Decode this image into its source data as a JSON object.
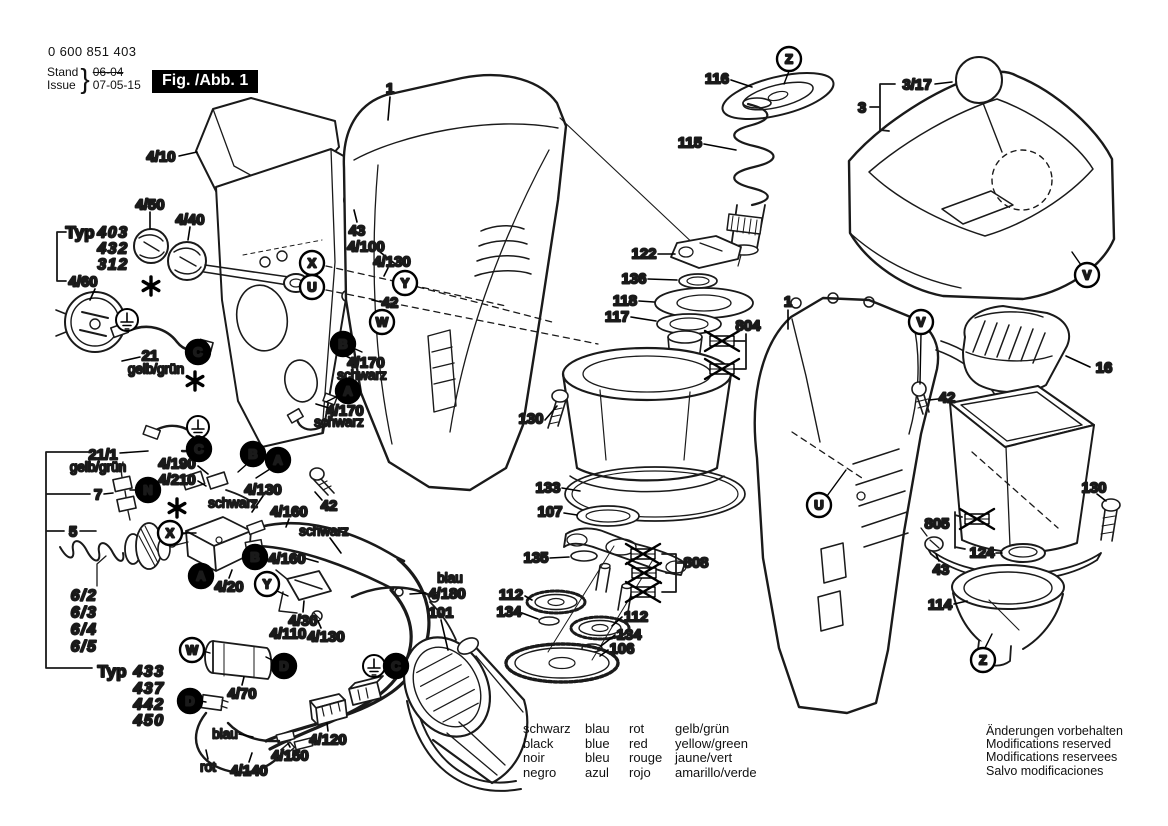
{
  "header": {
    "doc_number": "0 600 851 403",
    "stand_label": "Stand",
    "issue_label": "Issue",
    "brace": "}",
    "stand_value": "06-04",
    "issue_value": "07-05-15",
    "figure_label": "Fig. /Abb. 1"
  },
  "color_legend": {
    "rows": [
      [
        "schwarz",
        "blau",
        "rot",
        "gelb/grün"
      ],
      [
        "black",
        "blue",
        "red",
        "yellow/green"
      ],
      [
        "noir",
        "bleu",
        "rouge",
        "jaune/vert"
      ],
      [
        "negro",
        "azul",
        "rojo",
        "amarillo/verde"
      ]
    ]
  },
  "footer_notes": [
    "Änderungen vorbehalten",
    "Modifications reserved",
    "Modifications reservees",
    "Salvo modificaciones"
  ],
  "diagram": {
    "part_labels": [
      {
        "t": "1",
        "x": 390,
        "y": 88,
        "l": [
          390,
          97,
          388,
          120
        ]
      },
      {
        "t": "4/10",
        "x": 161,
        "y": 156,
        "l": [
          179,
          156,
          197,
          152
        ]
      },
      {
        "t": "4/50",
        "x": 150,
        "y": 204,
        "l": [
          150,
          212,
          150,
          228
        ]
      },
      {
        "t": "4/40",
        "x": 190,
        "y": 219,
        "l": [
          190,
          227,
          188,
          240
        ]
      },
      {
        "t": "43",
        "x": 357,
        "y": 230,
        "l": [
          357,
          222,
          354,
          210
        ]
      },
      {
        "t": "4/100",
        "x": 366,
        "y": 246,
        "l": [
          380,
          252,
          398,
          266
        ]
      },
      {
        "t": "4/130",
        "x": 392,
        "y": 261,
        "l": [
          388,
          268,
          384,
          276
        ]
      },
      {
        "t": "42",
        "x": 390,
        "y": 302,
        "l": [
          381,
          302,
          372,
          300
        ]
      },
      {
        "t": "4/170",
        "x": 366,
        "y": 362,
        "l": [
          350,
          358,
          338,
          352
        ]
      },
      {
        "t": "schwarz",
        "x": 362,
        "y": 375,
        "k": "c"
      },
      {
        "t": "4/170",
        "x": 345,
        "y": 410,
        "l": [
          329,
          408,
          316,
          404
        ]
      },
      {
        "t": "schwarz",
        "x": 339,
        "y": 422,
        "k": "c"
      },
      {
        "t": "Typ",
        "x": 80,
        "y": 232,
        "k": "typ"
      },
      {
        "t": "403",
        "x": 113,
        "y": 232,
        "k": "it"
      },
      {
        "t": "432",
        "x": 113,
        "y": 248,
        "k": "it"
      },
      {
        "t": "312",
        "x": 113,
        "y": 264,
        "k": "it"
      },
      {
        "t": "4/60",
        "x": 83,
        "y": 281,
        "l": [
          95,
          289,
          90,
          300
        ]
      },
      {
        "t": "21",
        "x": 150,
        "y": 355,
        "l": [
          140,
          357,
          122,
          361
        ]
      },
      {
        "t": "gelb/grün",
        "x": 156,
        "y": 369,
        "k": "c"
      },
      {
        "t": "21/1",
        "x": 103,
        "y": 454,
        "l": [
          120,
          453,
          148,
          451
        ]
      },
      {
        "t": "gelb/grün",
        "x": 98,
        "y": 467,
        "k": "c"
      },
      {
        "t": "7",
        "x": 98,
        "y": 494,
        "l": [
          104,
          494,
          113,
          493
        ]
      },
      {
        "t": "4/190",
        "x": 177,
        "y": 463,
        "l": [
          198,
          466,
          208,
          474
        ]
      },
      {
        "t": "4/210",
        "x": 177,
        "y": 479,
        "l": [
          198,
          481,
          206,
          486
        ]
      },
      {
        "t": "schwarz",
        "x": 233,
        "y": 503,
        "k": "c"
      },
      {
        "t": "4/130",
        "x": 263,
        "y": 489,
        "l": [
          263,
          496,
          252,
          512
        ]
      },
      {
        "t": "5",
        "x": 73,
        "y": 531,
        "l": [
          80,
          531,
          96,
          531
        ]
      },
      {
        "t": "6/2",
        "x": 84,
        "y": 595,
        "k": "it"
      },
      {
        "t": "6/3",
        "x": 84,
        "y": 612,
        "k": "it"
      },
      {
        "t": "6/4",
        "x": 84,
        "y": 629,
        "k": "it"
      },
      {
        "t": "6/5",
        "x": 84,
        "y": 646,
        "k": "it"
      },
      {
        "t": "Typ",
        "x": 112,
        "y": 671,
        "k": "typ"
      },
      {
        "t": "433",
        "x": 149,
        "y": 671,
        "k": "it"
      },
      {
        "t": "437",
        "x": 149,
        "y": 688,
        "k": "it"
      },
      {
        "t": "442",
        "x": 149,
        "y": 704,
        "k": "it"
      },
      {
        "t": "450",
        "x": 149,
        "y": 720,
        "k": "it"
      },
      {
        "t": "4/20",
        "x": 229,
        "y": 586,
        "l": [
          229,
          578,
          232,
          570
        ]
      },
      {
        "t": "4/160",
        "x": 289,
        "y": 511,
        "l": [
          289,
          519,
          286,
          527
        ]
      },
      {
        "t": "schwarz",
        "x": 324,
        "y": 531,
        "k": "c",
        "l": [
          330,
          538,
          341,
          553
        ]
      },
      {
        "t": "4/160",
        "x": 287,
        "y": 558,
        "l": [
          304,
          558,
          318,
          562
        ]
      },
      {
        "t": "42",
        "x": 329,
        "y": 505,
        "l": [
          322,
          500,
          315,
          492
        ]
      },
      {
        "t": "blau",
        "x": 450,
        "y": 578,
        "k": "c"
      },
      {
        "t": "4/180",
        "x": 447,
        "y": 593,
        "l": [
          425,
          593,
          410,
          594
        ]
      },
      {
        "t": "101",
        "x": 441,
        "y": 612,
        "l": [
          441,
          620,
          448,
          650
        ]
      },
      {
        "t": "4/30",
        "x": 303,
        "y": 620,
        "l": [
          303,
          612,
          304,
          601
        ]
      },
      {
        "t": "4/110",
        "x": 288,
        "y": 633
      },
      {
        "t": "4/130",
        "x": 326,
        "y": 636,
        "l": [
          321,
          628,
          318,
          621
        ]
      },
      {
        "t": "4/70",
        "x": 242,
        "y": 693,
        "l": [
          242,
          685,
          244,
          677
        ]
      },
      {
        "t": "blau",
        "x": 225,
        "y": 734,
        "k": "c",
        "l": [
          239,
          734,
          253,
          737
        ]
      },
      {
        "t": "4/120",
        "x": 328,
        "y": 739,
        "l": [
          328,
          731,
          327,
          723
        ]
      },
      {
        "t": "4/150",
        "x": 290,
        "y": 755,
        "l": [
          290,
          747,
          288,
          743
        ]
      },
      {
        "t": "rot",
        "x": 208,
        "y": 767,
        "k": "c",
        "l": [
          208,
          759,
          206,
          750
        ]
      },
      {
        "t": "4/140",
        "x": 249,
        "y": 770,
        "l": [
          249,
          762,
          252,
          753
        ]
      },
      {
        "t": "116",
        "x": 717,
        "y": 78,
        "l": [
          731,
          80,
          752,
          87
        ]
      },
      {
        "t": "115",
        "x": 690,
        "y": 142,
        "l": [
          704,
          144,
          736,
          150
        ]
      },
      {
        "t": "122",
        "x": 644,
        "y": 253,
        "l": [
          658,
          254,
          675,
          254
        ]
      },
      {
        "t": "136",
        "x": 634,
        "y": 278,
        "l": [
          648,
          279,
          677,
          280
        ]
      },
      {
        "t": "118",
        "x": 625,
        "y": 300,
        "l": [
          639,
          301,
          654,
          302
        ]
      },
      {
        "t": "117",
        "x": 617,
        "y": 316,
        "l": [
          631,
          317,
          656,
          321
        ]
      },
      {
        "t": "804",
        "x": 748,
        "y": 325
      },
      {
        "t": "1",
        "x": 788,
        "y": 301,
        "l": [
          788,
          310,
          788,
          329
        ]
      },
      {
        "t": "130",
        "x": 531,
        "y": 418,
        "l": [
          545,
          420,
          557,
          406
        ]
      },
      {
        "t": "133",
        "x": 548,
        "y": 487,
        "l": [
          562,
          488,
          580,
          491
        ]
      },
      {
        "t": "107",
        "x": 550,
        "y": 511,
        "l": [
          564,
          513,
          577,
          515
        ]
      },
      {
        "t": "135",
        "x": 536,
        "y": 557,
        "l": [
          550,
          558,
          569,
          557
        ]
      },
      {
        "t": "112",
        "x": 511,
        "y": 594,
        "l": [
          525,
          596,
          532,
          600
        ]
      },
      {
        "t": "134",
        "x": 509,
        "y": 611,
        "l": [
          522,
          613,
          538,
          619
        ]
      },
      {
        "t": "112",
        "x": 636,
        "y": 616,
        "l": [
          622,
          617,
          612,
          626
        ]
      },
      {
        "t": "134",
        "x": 629,
        "y": 634,
        "l": [
          615,
          635,
          601,
          646
        ]
      },
      {
        "t": "106",
        "x": 622,
        "y": 648,
        "l": [
          608,
          650,
          600,
          656
        ]
      },
      {
        "t": "808",
        "x": 696,
        "y": 562
      },
      {
        "t": "3/17",
        "x": 917,
        "y": 84,
        "l": [
          935,
          84,
          952,
          82
        ]
      },
      {
        "t": "3",
        "x": 862,
        "y": 107
      },
      {
        "t": "16",
        "x": 1104,
        "y": 367,
        "l": [
          1090,
          367,
          1066,
          356
        ]
      },
      {
        "t": "42",
        "x": 947,
        "y": 397,
        "l": [
          938,
          399,
          929,
          400
        ]
      },
      {
        "t": "130",
        "x": 1094,
        "y": 487,
        "l": [
          1097,
          494,
          1106,
          501
        ]
      },
      {
        "t": "805",
        "x": 937,
        "y": 523
      },
      {
        "t": "124",
        "x": 982,
        "y": 552,
        "l": [
          996,
          553,
          1002,
          553
        ]
      },
      {
        "t": "43",
        "x": 941,
        "y": 569,
        "l": [
          939,
          561,
          936,
          554
        ]
      },
      {
        "t": "114",
        "x": 940,
        "y": 604,
        "l": [
          954,
          604,
          967,
          601
        ]
      }
    ],
    "callouts": [
      {
        "ch": "Z",
        "x": 789,
        "y": 59,
        "f": false,
        "l": [
          789,
          71,
          784,
          84
        ]
      },
      {
        "ch": "X",
        "x": 312,
        "y": 263,
        "f": false
      },
      {
        "ch": "U",
        "x": 312,
        "y": 287,
        "f": false
      },
      {
        "ch": "Y",
        "x": 405,
        "y": 283,
        "f": false
      },
      {
        "ch": "W",
        "x": 382,
        "y": 322,
        "f": false
      },
      {
        "ch": "B",
        "x": 343,
        "y": 344,
        "f": true,
        "l": [
          353,
          348,
          362,
          352
        ]
      },
      {
        "ch": "A",
        "x": 348,
        "y": 391,
        "f": true,
        "l": [
          338,
          396,
          326,
          402
        ]
      },
      {
        "ch": "C",
        "x": 198,
        "y": 352,
        "f": true
      },
      {
        "ch": "C",
        "x": 199,
        "y": 449,
        "f": true
      },
      {
        "ch": "B",
        "x": 253,
        "y": 454,
        "f": true,
        "l": [
          247,
          464,
          238,
          472
        ]
      },
      {
        "ch": "A",
        "x": 278,
        "y": 460,
        "f": true,
        "l": [
          270,
          469,
          256,
          478
        ]
      },
      {
        "ch": "N",
        "x": 148,
        "y": 490,
        "f": true,
        "l": [
          138,
          490,
          130,
          490
        ]
      },
      {
        "ch": "X",
        "x": 170,
        "y": 533,
        "f": false,
        "l": [
          182,
          533,
          196,
          533
        ]
      },
      {
        "ch": "B",
        "x": 255,
        "y": 557,
        "f": true
      },
      {
        "ch": "A",
        "x": 201,
        "y": 576,
        "f": true
      },
      {
        "ch": "Y",
        "x": 267,
        "y": 584,
        "f": false,
        "l": [
          277,
          591,
          288,
          596
        ]
      },
      {
        "ch": "W",
        "x": 192,
        "y": 650,
        "f": false,
        "l": [
          203,
          651,
          210,
          653
        ]
      },
      {
        "ch": "D",
        "x": 284,
        "y": 666,
        "f": true,
        "l": [
          274,
          661,
          266,
          657
        ]
      },
      {
        "ch": "C",
        "x": 396,
        "y": 666,
        "f": true
      },
      {
        "ch": "D",
        "x": 190,
        "y": 701,
        "f": true,
        "l": [
          200,
          701,
          206,
          702
        ]
      },
      {
        "ch": "V",
        "x": 921,
        "y": 322,
        "f": false,
        "l": [
          921,
          334,
          920,
          384
        ]
      },
      {
        "ch": "V",
        "x": 1087,
        "y": 275,
        "f": false,
        "l": [
          1081,
          265,
          1072,
          252
        ]
      },
      {
        "ch": "U",
        "x": 819,
        "y": 505,
        "f": false,
        "l": [
          827,
          496,
          846,
          470
        ]
      },
      {
        "ch": "Z",
        "x": 983,
        "y": 660,
        "f": false,
        "l": [
          985,
          648,
          992,
          634
        ]
      }
    ],
    "symbols": [
      {
        "type": "ground",
        "x": 127,
        "y": 320
      },
      {
        "type": "ground",
        "x": 198,
        "y": 427
      },
      {
        "type": "ground",
        "x": 374,
        "y": 666
      },
      {
        "type": "asterisk",
        "x": 151,
        "y": 286
      },
      {
        "type": "asterisk",
        "x": 195,
        "y": 381
      },
      {
        "type": "asterisk",
        "x": 177,
        "y": 508
      },
      {
        "type": "crossed",
        "x": 722,
        "y": 341
      },
      {
        "type": "crossed",
        "x": 722,
        "y": 369
      },
      {
        "type": "crossed",
        "x": 643,
        "y": 554
      },
      {
        "type": "crossed",
        "x": 644,
        "y": 573
      },
      {
        "type": "crossed",
        "x": 643,
        "y": 592
      },
      {
        "type": "crossed",
        "x": 977,
        "y": 519
      }
    ],
    "dashes": [
      [
        326,
        266,
        506,
        306
      ],
      [
        326,
        290,
        598,
        344
      ],
      [
        418,
        287,
        556,
        323
      ],
      [
        792,
        432,
        862,
        478
      ],
      [
        972,
        452,
        1058,
        528
      ]
    ]
  }
}
